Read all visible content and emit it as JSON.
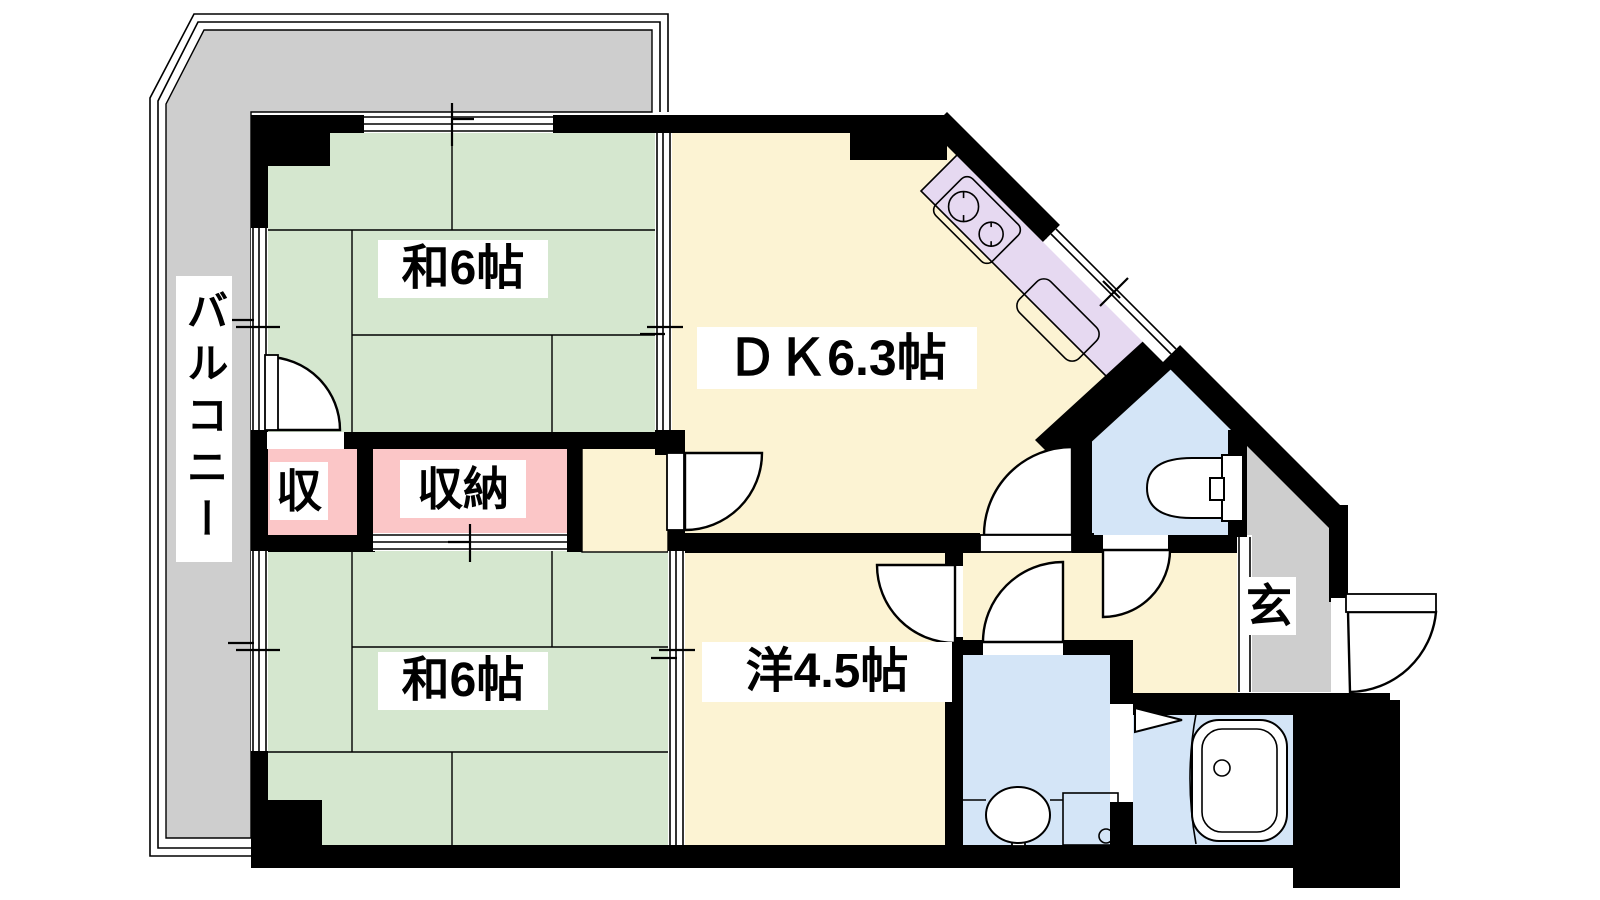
{
  "floorplan": {
    "rooms": {
      "balcony": {
        "label": "バルコニー"
      },
      "japanese_room_top": {
        "label": "和6帖"
      },
      "japanese_room_bottom": {
        "label": "和6帖"
      },
      "dining_kitchen": {
        "label": "ＤＫ6.3帖"
      },
      "western_room": {
        "label": "洋4.5帖"
      },
      "closet_small": {
        "label": "収"
      },
      "closet_large": {
        "label": "収納"
      },
      "entrance": {
        "label": "玄"
      }
    },
    "colors": {
      "wall": "#000000",
      "balcony_floor": "#cecece",
      "tatami_floor": "#d5e7cf",
      "wood_floor": "#fcf3d3",
      "closet_floor": "#fbc6c7",
      "kitchen_counter": "#e6d9f1",
      "sanitary_floor": "#d4e5f7",
      "background": "#ffffff"
    }
  }
}
